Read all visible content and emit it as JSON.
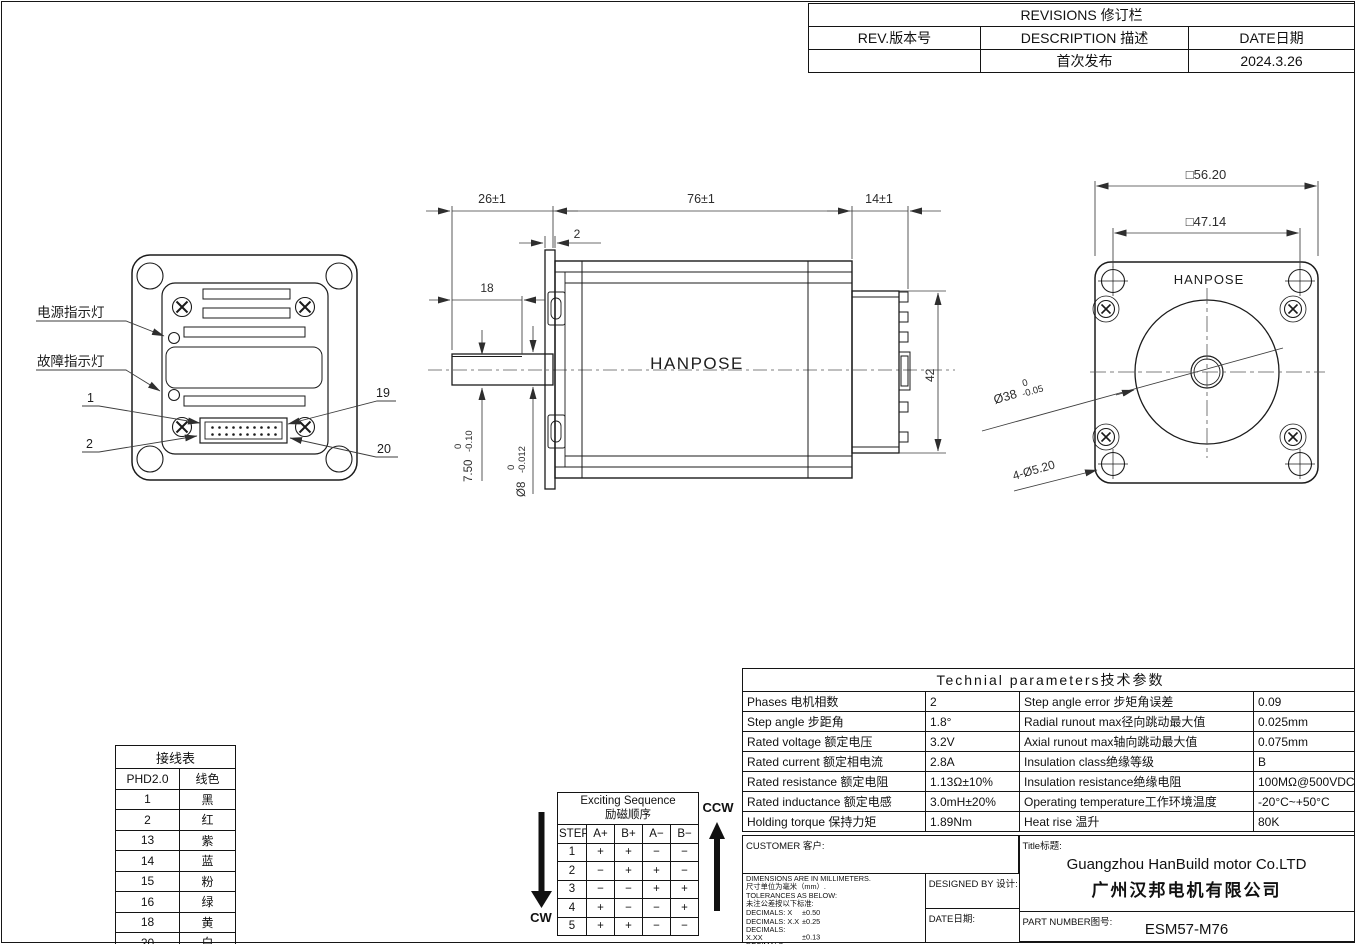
{
  "revisions": {
    "title": "REVISIONS 修订栏",
    "col_rev": "REV.版本号",
    "col_desc": "DESCRIPTION 描述",
    "col_date": "DATE日期",
    "rev": "",
    "desc": "首次发布",
    "date": "2024.3.26"
  },
  "rear_view": {
    "label_power": "电源指示灯",
    "label_fault": "故障指示灯",
    "pin_1": "1",
    "pin_2": "2",
    "pin_19": "19",
    "pin_20": "20"
  },
  "side_view": {
    "brand": "HANPOSE",
    "dim_shaft_len": "26±1",
    "dim_body_len": "76±1",
    "dim_rear_len": "14±1",
    "dim_flange_thk": "2",
    "dim_flat_len": "18",
    "dim_rear_h": "42",
    "flat": {
      "value": "7.50",
      "tol_hi": "0",
      "tol_lo": "-0.10"
    },
    "shaft": {
      "value": "Ø8",
      "tol_hi": "0",
      "tol_lo": "-0.012"
    }
  },
  "front_view": {
    "brand": "HANPOSE",
    "dim_outer": "□56.20",
    "dim_holes_span": "□47.14",
    "pilot": {
      "value": "Ø38",
      "tol_hi": "0",
      "tol_lo": "-0.05"
    },
    "dim_mount_holes": "4-Ø5.20"
  },
  "wiring": {
    "title": "接线表",
    "col_pin": "PHD2.0",
    "col_color": "线色",
    "rows": [
      [
        "1",
        "黑"
      ],
      [
        "2",
        "红"
      ],
      [
        "13",
        "紫"
      ],
      [
        "14",
        "蓝"
      ],
      [
        "15",
        "粉"
      ],
      [
        "16",
        "绿"
      ],
      [
        "18",
        "黄"
      ],
      [
        "20",
        "白"
      ]
    ]
  },
  "exciting": {
    "title_en": "Exciting Sequence",
    "title_cn": "励磁顺序",
    "headers": [
      "STEP",
      "A+",
      "B+",
      "A−",
      "B−"
    ],
    "rows": [
      [
        "1",
        "+",
        "+",
        "−",
        "−"
      ],
      [
        "2",
        "−",
        "+",
        "+",
        "−"
      ],
      [
        "3",
        "−",
        "−",
        "+",
        "+"
      ],
      [
        "4",
        "+",
        "−",
        "−",
        "+"
      ],
      [
        "5",
        "+",
        "+",
        "−",
        "−"
      ]
    ],
    "cw": "CW",
    "ccw": "CCW"
  },
  "tech": {
    "title": "Technial parameters技术参数",
    "rows": [
      {
        "l1": "Phases 电机相数",
        "v1": "2",
        "l2": "Step angle error 步矩角误差",
        "v2": "0.09"
      },
      {
        "l1": "Step angle 步距角",
        "v1": "1.8°",
        "l2": "Radial runout max径向跳动最大值",
        "v2": "0.025mm"
      },
      {
        "l1": "Rated voltage 额定电压",
        "v1": "3.2V",
        "l2": "Axial runout max轴向跳动最大值",
        "v2": "0.075mm"
      },
      {
        "l1": "Rated current 额定相电流",
        "v1": "2.8A",
        "l2": "Insulation class绝缘等级",
        "v2": "B"
      },
      {
        "l1": "Rated resistance 额定电阻",
        "v1": "1.13Ω±10%",
        "l2": "Insulation resistance绝缘电阻",
        "v2": "100MΩ@500VDC"
      },
      {
        "l1": "Rated inductance 额定电感",
        "v1": "3.0mH±20%",
        "l2": "Operating temperature工作环境温度",
        "v2": "-20°C~+50°C"
      },
      {
        "l1": "Holding torque 保持力矩",
        "v1": "1.89Nm",
        "l2": "Heat rise 温升",
        "v2": "80K"
      }
    ]
  },
  "title_block": {
    "customer_label": "CUSTOMER 客户:",
    "notes": [
      "DIMENSIONS ARE IN MILLIMETERS.",
      "尺寸单位为毫米（mm）.",
      "TOLERANCES AS BELOW:",
      "未注公差按以下标准:"
    ],
    "tolerances": [
      {
        "label": "DECIMALS: X",
        "value": "±0.50"
      },
      {
        "label": "DECIMALS: X.X",
        "value": "±0.25"
      },
      {
        "label": "DECIMALS: X.XX",
        "value": "±0.13"
      },
      {
        "label": "DECIMALS: X.XXX",
        "value": "±0.013"
      },
      {
        "label": "ANGLES:",
        "value": "±2°"
      }
    ],
    "designed_label": "DESIGNED BY 设计:",
    "date_label": "DATE日期:",
    "title_label": "Title标题:",
    "company_en": "Guangzhou HanBuild motor Co.LTD",
    "company_cn": "广州汉邦电机有限公司",
    "part_label": "PART NUMBER图号:",
    "part_number": "ESM57-M76"
  }
}
